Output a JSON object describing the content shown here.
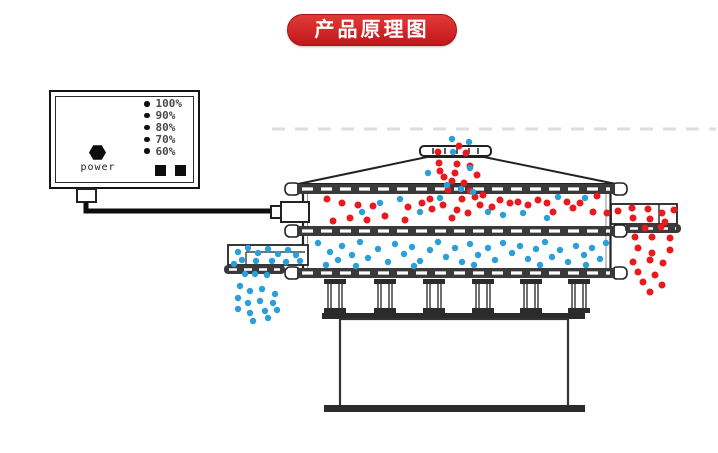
{
  "banner": {
    "title": "产品原理图",
    "bg_top": "#e23b36",
    "bg_bottom": "#c0161d",
    "text_color": "#ffffff"
  },
  "power_box": {
    "power_label": "power",
    "levels": [
      "100%",
      "90%",
      "80%",
      "70%",
      "60%"
    ],
    "indicator_squares": 2
  },
  "colors": {
    "coarse_particle": "#e8191f",
    "fine_particle": "#2b9fd9",
    "line": "#222222",
    "band": "#3a3a3a",
    "banner_bg": "#cf2126"
  },
  "particles": {
    "groups": [
      {
        "name": "inlet-stream-red",
        "color_ref": "coarse_particle",
        "radius": 3.5,
        "points": [
          [
            459,
            146
          ],
          [
            438,
            152
          ],
          [
            466,
            153
          ],
          [
            439,
            163
          ],
          [
            457,
            164
          ],
          [
            470,
            166
          ],
          [
            440,
            171
          ],
          [
            455,
            173
          ],
          [
            444,
            177
          ],
          [
            477,
            175
          ],
          [
            452,
            181
          ],
          [
            464,
            183
          ],
          [
            448,
            190
          ],
          [
            470,
            191
          ]
        ]
      },
      {
        "name": "inlet-stream-blue",
        "color_ref": "fine_particle",
        "radius": 3.2,
        "points": [
          [
            452,
            139
          ],
          [
            469,
            142
          ],
          [
            453,
            152
          ],
          [
            428,
            173
          ],
          [
            470,
            168
          ],
          [
            447,
            185
          ],
          [
            461,
            189
          ]
        ]
      },
      {
        "name": "upper-deck-red",
        "color_ref": "coarse_particle",
        "radius": 3.5,
        "points": [
          [
            327,
            199
          ],
          [
            342,
            203
          ],
          [
            358,
            205
          ],
          [
            373,
            206
          ],
          [
            350,
            218
          ],
          [
            333,
            221
          ],
          [
            367,
            220
          ],
          [
            385,
            216
          ],
          [
            408,
            207
          ],
          [
            405,
            220
          ],
          [
            422,
            203
          ],
          [
            430,
            199
          ],
          [
            432,
            209
          ],
          [
            443,
            205
          ],
          [
            452,
            218
          ],
          [
            462,
            199
          ],
          [
            475,
            197
          ],
          [
            483,
            195
          ],
          [
            500,
            200
          ],
          [
            480,
            205
          ],
          [
            492,
            207
          ],
          [
            510,
            203
          ],
          [
            518,
            202
          ],
          [
            528,
            205
          ],
          [
            538,
            200
          ],
          [
            547,
            203
          ],
          [
            553,
            212
          ],
          [
            567,
            202
          ],
          [
            573,
            208
          ],
          [
            580,
            203
          ],
          [
            593,
            212
          ],
          [
            607,
            213
          ],
          [
            597,
            196
          ],
          [
            457,
            210
          ],
          [
            468,
            213
          ]
        ]
      },
      {
        "name": "upper-deck-blue",
        "color_ref": "fine_particle",
        "radius": 3.2,
        "points": [
          [
            473,
            192
          ],
          [
            488,
            212
          ],
          [
            503,
            215
          ],
          [
            523,
            213
          ],
          [
            558,
            197
          ],
          [
            585,
            198
          ],
          [
            547,
            218
          ],
          [
            400,
            199
          ],
          [
            440,
            198
          ],
          [
            420,
            212
          ],
          [
            380,
            203
          ],
          [
            362,
            212
          ]
        ]
      },
      {
        "name": "lower-deck-blue",
        "color_ref": "fine_particle",
        "radius": 3.2,
        "points": [
          [
            318,
            243
          ],
          [
            330,
            252
          ],
          [
            342,
            246
          ],
          [
            338,
            260
          ],
          [
            352,
            255
          ],
          [
            360,
            242
          ],
          [
            368,
            258
          ],
          [
            378,
            249
          ],
          [
            388,
            262
          ],
          [
            395,
            244
          ],
          [
            404,
            254
          ],
          [
            412,
            247
          ],
          [
            420,
            261
          ],
          [
            430,
            250
          ],
          [
            438,
            242
          ],
          [
            446,
            257
          ],
          [
            455,
            248
          ],
          [
            462,
            262
          ],
          [
            470,
            244
          ],
          [
            478,
            255
          ],
          [
            488,
            248
          ],
          [
            495,
            260
          ],
          [
            503,
            243
          ],
          [
            512,
            253
          ],
          [
            520,
            246
          ],
          [
            528,
            259
          ],
          [
            536,
            249
          ],
          [
            545,
            242
          ],
          [
            552,
            257
          ],
          [
            560,
            250
          ],
          [
            568,
            262
          ],
          [
            576,
            246
          ],
          [
            584,
            255
          ],
          [
            592,
            248
          ],
          [
            600,
            259
          ],
          [
            606,
            243
          ],
          [
            326,
            265
          ],
          [
            356,
            266
          ],
          [
            414,
            266
          ],
          [
            474,
            265
          ],
          [
            540,
            265
          ],
          [
            586,
            265
          ]
        ]
      },
      {
        "name": "left-outlet-blue",
        "color_ref": "fine_particle",
        "radius": 3.2,
        "points": [
          [
            238,
            252
          ],
          [
            248,
            248
          ],
          [
            258,
            253
          ],
          [
            268,
            249
          ],
          [
            278,
            254
          ],
          [
            288,
            250
          ],
          [
            296,
            255
          ],
          [
            242,
            260
          ],
          [
            256,
            261
          ],
          [
            272,
            261
          ],
          [
            286,
            262
          ],
          [
            234,
            264
          ],
          [
            300,
            261
          ]
        ]
      },
      {
        "name": "left-discharge-blue",
        "color_ref": "fine_particle",
        "radius": 3.2,
        "points": [
          [
            245,
            274
          ],
          [
            255,
            274
          ],
          [
            267,
            275
          ],
          [
            240,
            286
          ],
          [
            250,
            291
          ],
          [
            262,
            289
          ],
          [
            275,
            294
          ],
          [
            238,
            298
          ],
          [
            248,
            303
          ],
          [
            260,
            301
          ],
          [
            273,
            303
          ],
          [
            238,
            309
          ],
          [
            250,
            313
          ],
          [
            265,
            311
          ],
          [
            253,
            321
          ],
          [
            268,
            318
          ],
          [
            277,
            310
          ]
        ]
      },
      {
        "name": "right-chute-red",
        "color_ref": "coarse_particle",
        "radius": 3.5,
        "points": [
          [
            618,
            211
          ],
          [
            632,
            208
          ],
          [
            648,
            209
          ],
          [
            662,
            213
          ],
          [
            633,
            218
          ],
          [
            650,
            219
          ],
          [
            665,
            222
          ],
          [
            674,
            210
          ],
          [
            645,
            228
          ],
          [
            661,
            227
          ]
        ]
      },
      {
        "name": "right-discharge-red",
        "color_ref": "coarse_particle",
        "radius": 3.5,
        "points": [
          [
            635,
            237
          ],
          [
            652,
            237
          ],
          [
            670,
            238
          ],
          [
            638,
            248
          ],
          [
            652,
            253
          ],
          [
            670,
            250
          ],
          [
            633,
            262
          ],
          [
            650,
            260
          ],
          [
            663,
            263
          ],
          [
            638,
            272
          ],
          [
            655,
            275
          ],
          [
            643,
            282
          ],
          [
            662,
            285
          ],
          [
            650,
            292
          ]
        ]
      }
    ]
  }
}
